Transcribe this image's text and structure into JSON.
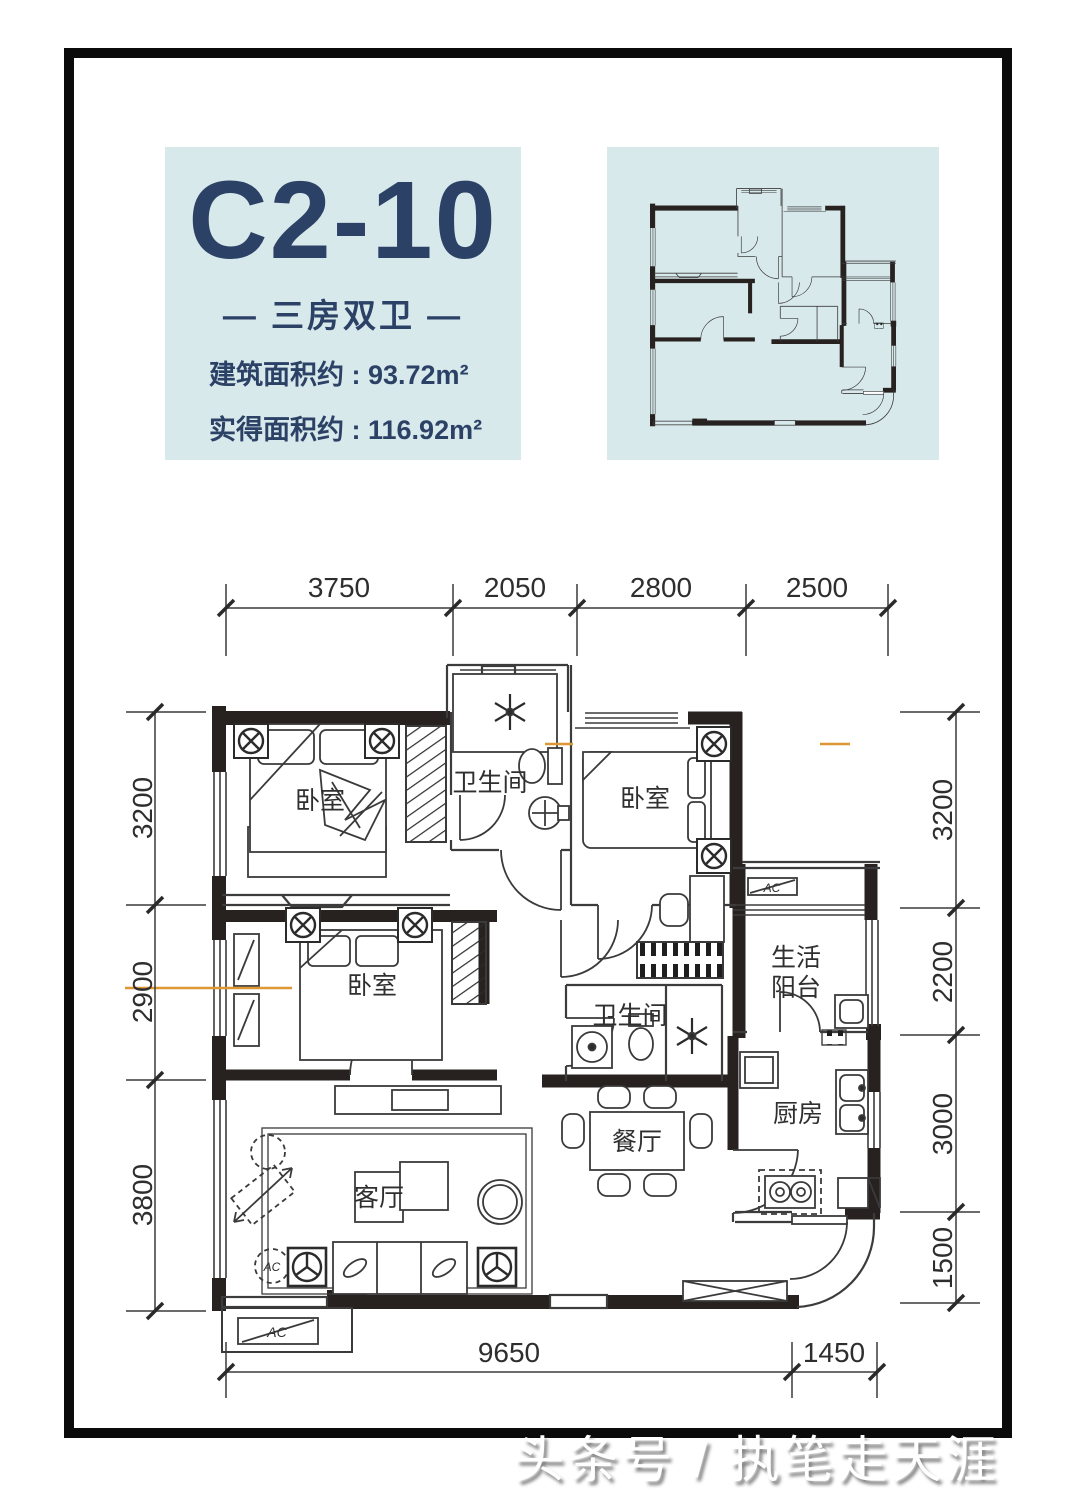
{
  "panel": {
    "unit_code": "C2-10",
    "unit_type": "— 三房双卫 —",
    "area_lines": [
      "建筑面积约 : 93.72m²",
      "实得面积约 : 116.92m²"
    ]
  },
  "dimensions": {
    "top": [
      "3750",
      "2050",
      "2800",
      "2500"
    ],
    "left": [
      "3200",
      "2900",
      "3800"
    ],
    "right": [
      "3200",
      "2200",
      "3000",
      "1500"
    ],
    "bottom": [
      "9650",
      "1450"
    ]
  },
  "rooms": {
    "bedroom_a": "卧室",
    "bedroom_b": "卧室",
    "bedroom_c": "卧室",
    "bathroom_a": "卫生间",
    "bathroom_b": "卫生间",
    "balcony_line1": "生活",
    "balcony_line2": "阳台",
    "kitchen": "厨房",
    "dining": "餐厅",
    "living": "客厅"
  },
  "annotations": {
    "ac": "AC"
  },
  "watermark": "头条号 / 执笔走天涯",
  "colors": {
    "panel_bg": "#d8e9ec",
    "title_navy": "#2c4166",
    "wall": "#272220",
    "line": "#3a3a3a",
    "accent_orange": "#dd9733"
  }
}
